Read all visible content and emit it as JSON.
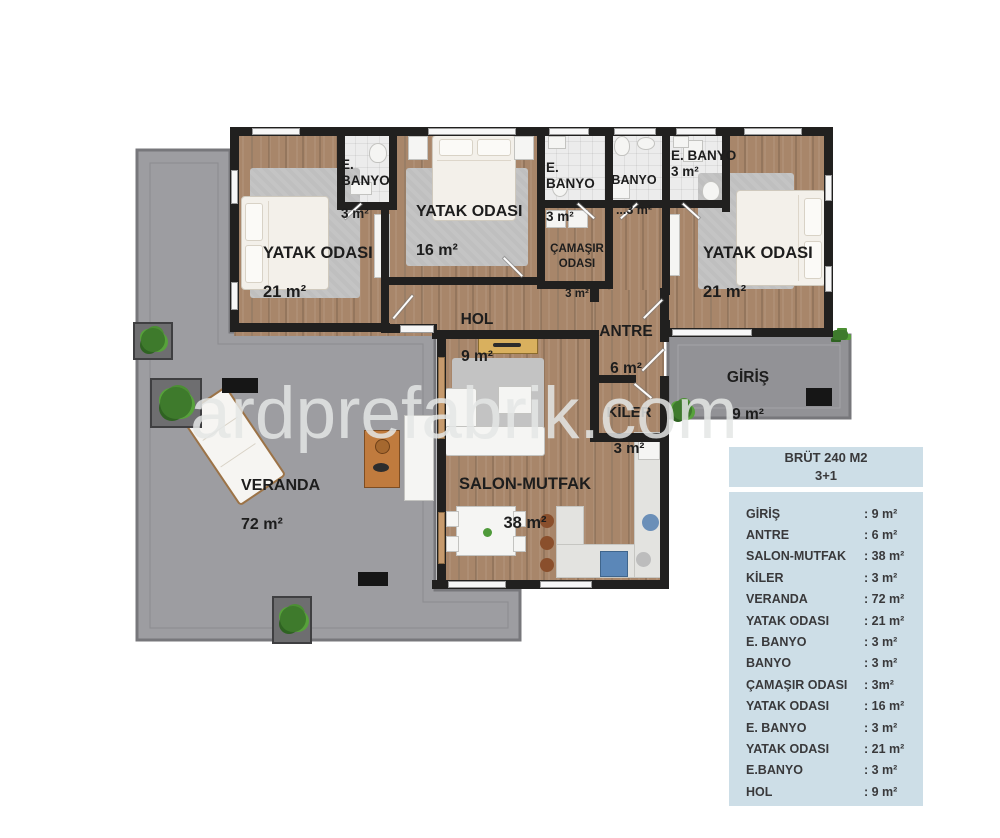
{
  "watermark": "ardprefabrik.com",
  "plan": {
    "rooms": {
      "bedroom_left": {
        "name": "YATAK ODASI",
        "area": "21 m²"
      },
      "ensuite_bath_left": {
        "name": "E. BANYO",
        "area": "3 m²"
      },
      "bedroom_middle": {
        "name": "YATAK ODASI",
        "area": "16 m²"
      },
      "ensuite_bath_mid": {
        "name": "E. BANYO",
        "area": "3 m²"
      },
      "bath": {
        "name": "BANYO",
        "area": "...3 m²"
      },
      "ensuite_bath_right": {
        "name": "E. BANYO",
        "area": "3 m²"
      },
      "bedroom_right": {
        "name": "YATAK ODASI",
        "area": "21 m²"
      },
      "laundry": {
        "name": "ÇAMAŞIR ODASI",
        "area": "3 m²"
      },
      "hall": {
        "name": "HOL",
        "area": "9 m²"
      },
      "antre": {
        "name": "ANTRE",
        "area": "6 m²"
      },
      "entrance": {
        "name": "GİRİŞ",
        "area": "9 m²"
      },
      "pantry": {
        "name": "KİLER",
        "area": "3 m²"
      },
      "living": {
        "name": "SALON-MUTFAK",
        "area": "38 m²"
      },
      "veranda": {
        "name": "VERANDA",
        "area": "72 m²"
      }
    },
    "colors": {
      "wall": "#21201f",
      "wood": "#a8866a",
      "veranda": "#9d9da1",
      "porch": "#929296"
    }
  },
  "info_table": {
    "title_line1": "BRÜT 240 M2",
    "title_line2": "3+1",
    "rows": [
      {
        "label": "GİRİŞ",
        "value": ": 9 m²"
      },
      {
        "label": "ANTRE",
        "value": ": 6 m²"
      },
      {
        "label": "SALON-MUTFAK",
        "value": ": 38 m²"
      },
      {
        "label": "KİLER",
        "value": ": 3 m²"
      },
      {
        "label": "VERANDA",
        "value": ": 72 m²"
      },
      {
        "label": "YATAK ODASI",
        "value": ": 21 m²"
      },
      {
        "label": "E. BANYO",
        "value": ": 3 m²"
      },
      {
        "label": "BANYO",
        "value": ": 3 m²"
      },
      {
        "label": "ÇAMAŞIR ODASI",
        "value": ": 3m²"
      },
      {
        "label": "YATAK ODASI",
        "value": ": 16 m²"
      },
      {
        "label": "E. BANYO",
        "value": ": 3 m²"
      },
      {
        "label": "YATAK ODASI",
        "value": ": 21 m²"
      },
      {
        "label": "E.BANYO",
        "value": ": 3 m²"
      },
      {
        "label": "HOL",
        "value": ": 9 m²"
      }
    ],
    "colors": {
      "panel_bg": "#cddee7",
      "text": "#39393b"
    }
  }
}
